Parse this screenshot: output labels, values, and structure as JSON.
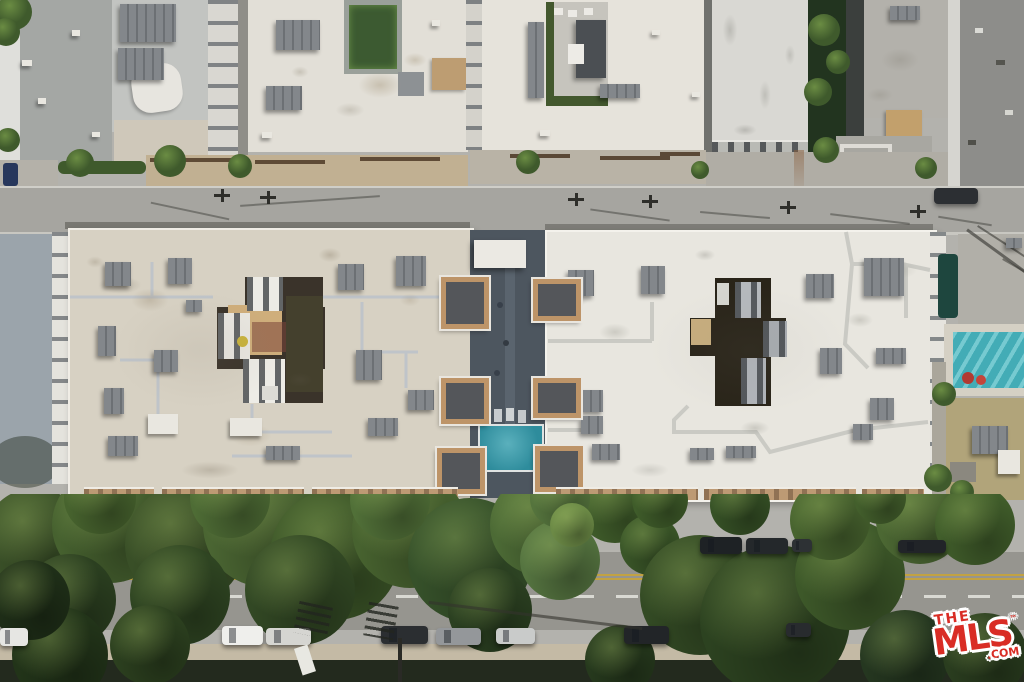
{
  "watermark": {
    "the": "THE",
    "mls": "MLS",
    "tm": "™",
    "com": ".COM"
  },
  "palette": {
    "background": "#b3b2ad",
    "roof_left_building": "#d7d1c3",
    "roof_right_building": "#e8e6df",
    "roof_top_white": "#e2dfd7",
    "road": "#a6a5a0",
    "road_lower": "#96958f",
    "sidewalk": "#c4baa5",
    "courtyard_deck": "#4d565f",
    "pool_center": "#2e8c9c",
    "pool_right": "#43acb6",
    "tan_trim": "#bd9a74",
    "tree_dark": "#2c4220",
    "tree_mid": "#3f5a2c",
    "shadow_strip": "#232a1e",
    "mls_red": "#d92d25"
  },
  "scene": {
    "units": [
      [
        120,
        4,
        56,
        38,
        "d"
      ],
      [
        118,
        48,
        46,
        32,
        "d"
      ],
      [
        276,
        20,
        44,
        30,
        "d"
      ],
      [
        266,
        86,
        36,
        24,
        "d"
      ],
      [
        600,
        84,
        40,
        14,
        "d"
      ],
      [
        890,
        6,
        30,
        14,
        "d"
      ],
      [
        528,
        22,
        16,
        76,
        "d"
      ],
      [
        22,
        60,
        10,
        6,
        "l"
      ],
      [
        38,
        98,
        8,
        6,
        "l"
      ],
      [
        72,
        30,
        8,
        6,
        "l"
      ],
      [
        92,
        132,
        8,
        5,
        "l"
      ],
      [
        262,
        132,
        10,
        6,
        "l"
      ],
      [
        432,
        20,
        8,
        6,
        "l"
      ],
      [
        652,
        30,
        8,
        5,
        "l"
      ],
      [
        692,
        92,
        8,
        5,
        "l"
      ],
      [
        540,
        130,
        10,
        6,
        "l"
      ],
      [
        105,
        262,
        26,
        24,
        "d"
      ],
      [
        168,
        258,
        24,
        26,
        "d"
      ],
      [
        338,
        264,
        26,
        26,
        "d"
      ],
      [
        396,
        256,
        30,
        30,
        "d"
      ],
      [
        98,
        326,
        18,
        30,
        "d"
      ],
      [
        154,
        350,
        24,
        22,
        "d"
      ],
      [
        104,
        388,
        20,
        26,
        "d"
      ],
      [
        108,
        436,
        30,
        20,
        "d"
      ],
      [
        356,
        350,
        26,
        30,
        "d"
      ],
      [
        408,
        390,
        26,
        20,
        "d"
      ],
      [
        368,
        418,
        30,
        18,
        "d"
      ],
      [
        266,
        446,
        34,
        14,
        "d"
      ],
      [
        186,
        300,
        16,
        12,
        "d"
      ],
      [
        148,
        414,
        30,
        20,
        "l"
      ],
      [
        230,
        418,
        32,
        18,
        "l"
      ],
      [
        568,
        270,
        26,
        26,
        "d"
      ],
      [
        641,
        266,
        24,
        28,
        "d"
      ],
      [
        806,
        274,
        28,
        24,
        "d"
      ],
      [
        864,
        258,
        40,
        38,
        "d"
      ],
      [
        820,
        348,
        22,
        26,
        "d"
      ],
      [
        876,
        348,
        30,
        16,
        "d"
      ],
      [
        870,
        398,
        24,
        22,
        "d"
      ],
      [
        853,
        424,
        20,
        16,
        "d"
      ],
      [
        726,
        446,
        30,
        12,
        "d"
      ],
      [
        583,
        390,
        20,
        22,
        "d"
      ],
      [
        581,
        416,
        22,
        18,
        "d"
      ],
      [
        592,
        444,
        28,
        16,
        "d"
      ],
      [
        690,
        448,
        24,
        12,
        "d"
      ],
      [
        972,
        426,
        36,
        28,
        "d"
      ],
      [
        1006,
        238,
        16,
        10,
        "d"
      ],
      [
        998,
        450,
        22,
        24,
        "l"
      ]
    ],
    "stains": [
      [
        150,
        300,
        26,
        16,
        "#8f7f66",
        0.3
      ],
      [
        250,
        435,
        30,
        16,
        "#8f8066",
        0.28
      ],
      [
        330,
        255,
        16,
        10,
        "#7c6f58",
        0.3
      ],
      [
        95,
        262,
        12,
        8,
        "#7c6f58",
        0.25
      ],
      [
        210,
        470,
        40,
        12,
        "#6e6352",
        0.25
      ],
      [
        410,
        300,
        14,
        9,
        "#8f7f66",
        0.22
      ],
      [
        300,
        380,
        18,
        10,
        "#5f584a",
        0.2
      ],
      [
        120,
        285,
        30,
        12,
        "#6b6253",
        0.3
      ],
      [
        200,
        350,
        120,
        80,
        "#8a8070",
        0.12
      ],
      [
        750,
        350,
        140,
        90,
        "#8e8a80",
        0.08
      ],
      [
        615,
        332,
        22,
        12,
        "#8a8a80",
        0.3
      ],
      [
        705,
        255,
        14,
        8,
        "#77776e",
        0.28
      ],
      [
        860,
        320,
        18,
        10,
        "#8a8a80",
        0.3
      ],
      [
        755,
        428,
        20,
        10,
        "#6f6f66",
        0.25
      ],
      [
        900,
        270,
        24,
        12,
        "#96968c",
        0.22
      ],
      [
        650,
        470,
        26,
        10,
        "#72726a",
        0.2
      ],
      [
        580,
        300,
        12,
        8,
        "#80807a",
        0.2
      ],
      [
        380,
        85,
        30,
        18,
        "#a89a80",
        0.45
      ],
      [
        415,
        60,
        16,
        10,
        "#a89a80",
        0.4
      ],
      [
        300,
        72,
        12,
        8,
        "#97907e",
        0.35
      ],
      [
        350,
        110,
        20,
        10,
        "#8f8878",
        0.3
      ],
      [
        730,
        30,
        10,
        22,
        "#8f8f88",
        0.4
      ],
      [
        765,
        95,
        8,
        20,
        "#8f8f88",
        0.35
      ],
      [
        790,
        55,
        7,
        14,
        "#85857e",
        0.3
      ],
      [
        745,
        130,
        16,
        8,
        "#6d6d66",
        0.3
      ],
      [
        900,
        60,
        26,
        16,
        "#8c887e",
        0.35
      ],
      [
        880,
        95,
        18,
        10,
        "#8c887e",
        0.3
      ]
    ],
    "shrubs": [
      [
        80,
        163,
        14
      ],
      [
        170,
        161,
        16
      ],
      [
        240,
        166,
        12
      ],
      [
        528,
        162,
        12
      ],
      [
        700,
        170,
        9
      ],
      [
        926,
        168,
        11
      ],
      [
        14,
        12,
        18
      ],
      [
        6,
        32,
        14
      ],
      [
        8,
        140,
        12
      ],
      [
        824,
        30,
        16
      ],
      [
        818,
        92,
        14
      ],
      [
        826,
        150,
        13
      ],
      [
        838,
        62,
        12
      ],
      [
        938,
        478,
        14
      ],
      [
        962,
        492,
        12
      ],
      [
        944,
        394,
        12
      ]
    ],
    "towers": [
      [
        441,
        277,
        38,
        42
      ],
      [
        441,
        378,
        38,
        36
      ],
      [
        437,
        448,
        38,
        36
      ],
      [
        533,
        279,
        38,
        32
      ],
      [
        533,
        378,
        38,
        30
      ],
      [
        535,
        446,
        38,
        36
      ]
    ],
    "balconies": [
      [
        84,
        70
      ],
      [
        162,
        142
      ],
      [
        312,
        146
      ],
      [
        556,
        142
      ],
      [
        704,
        152
      ],
      [
        862,
        62
      ]
    ],
    "trees": [
      [
        35,
        540,
        52,
        "#3c5329"
      ],
      [
        110,
        525,
        58,
        "#46612f"
      ],
      [
        185,
        545,
        60,
        "#394f27"
      ],
      [
        265,
        525,
        62,
        "#4a6532"
      ],
      [
        335,
        555,
        65,
        "#3c5628"
      ],
      [
        410,
        530,
        58,
        "#47622f"
      ],
      [
        300,
        590,
        55,
        "#324824"
      ],
      [
        180,
        595,
        50,
        "#2f4522"
      ],
      [
        70,
        600,
        46,
        "#2b3f20"
      ],
      [
        470,
        560,
        62,
        "#36512a"
      ],
      [
        540,
        525,
        50,
        "#4c6a35"
      ],
      [
        560,
        560,
        40,
        "#557440"
      ],
      [
        615,
        505,
        38,
        "#42602c"
      ],
      [
        490,
        610,
        42,
        "#2b4021"
      ],
      [
        650,
        545,
        30,
        "#3a5628"
      ],
      [
        700,
        595,
        60,
        "#334a24"
      ],
      [
        775,
        620,
        75,
        "#2c4220"
      ],
      [
        850,
        575,
        55,
        "#3d5829"
      ],
      [
        830,
        520,
        40,
        "#48642f"
      ],
      [
        920,
        520,
        44,
        "#4c6833"
      ],
      [
        975,
        525,
        40,
        "#415e2b"
      ],
      [
        905,
        655,
        45,
        "#253720"
      ],
      [
        985,
        655,
        42,
        "#2a3d1f"
      ],
      [
        620,
        660,
        35,
        "#26391d"
      ],
      [
        60,
        655,
        48,
        "#223419"
      ],
      [
        150,
        645,
        40,
        "#2c401f"
      ],
      [
        390,
        500,
        40,
        "#517038"
      ],
      [
        230,
        498,
        40,
        "#4e6c35"
      ],
      [
        100,
        498,
        36,
        "#47632e"
      ],
      [
        560,
        498,
        30,
        "#55743d"
      ],
      [
        660,
        500,
        28,
        "#3f5c2a"
      ],
      [
        740,
        505,
        30,
        "#365126"
      ],
      [
        880,
        498,
        26,
        "#435f2c"
      ],
      [
        30,
        600,
        40,
        "#1f2f18"
      ],
      [
        572,
        525,
        22,
        "#6c8a46"
      ]
    ],
    "cars_upper": [
      [
        700,
        537,
        42,
        17,
        "#1e2225"
      ],
      [
        746,
        538,
        42,
        16,
        "#24282b"
      ],
      [
        792,
        539,
        20,
        13,
        "#2d3134"
      ],
      [
        898,
        540,
        48,
        13,
        "#212428"
      ]
    ],
    "cars_lower": [
      [
        0,
        628,
        28,
        18,
        "#e6e6e3"
      ],
      [
        222,
        626,
        41,
        19,
        "#efefec"
      ],
      [
        266,
        628,
        45,
        17,
        "#d5d5d1"
      ],
      [
        381,
        626,
        47,
        18,
        "#2b2e31"
      ],
      [
        436,
        628,
        45,
        17,
        "#94979a"
      ],
      [
        496,
        628,
        39,
        16,
        "#c9cbca"
      ],
      [
        624,
        626,
        45,
        18,
        "#222528"
      ],
      [
        786,
        623,
        25,
        14,
        "#282b2e"
      ]
    ],
    "poles": [
      [
        222,
        194
      ],
      [
        268,
        196
      ],
      [
        576,
        198
      ],
      [
        650,
        200
      ],
      [
        788,
        206
      ],
      [
        918,
        210
      ]
    ],
    "wire_shadows": [
      [
        150,
        210,
        80,
        12
      ],
      [
        240,
        200,
        140,
        -4
      ],
      [
        590,
        214,
        80,
        8
      ],
      [
        700,
        214,
        70,
        5
      ],
      [
        830,
        218,
        80,
        7
      ],
      [
        938,
        220,
        54,
        9
      ]
    ],
    "ladder_shadows": [
      [
        296,
        604,
        34,
        32,
        12
      ],
      [
        366,
        604,
        30,
        34,
        10
      ]
    ],
    "long_shadows": [
      [
        428,
        614,
        215,
        7
      ]
    ],
    "pipes_left": "M70 297 H213 M323 297 H466 M152 262 V296 M252 404 V432 H332 M120 360 H158 V416 M362 302 V352 H418 M232 456 H352 M406 352 V388",
    "pipes_right": "M548 341 H652 M652 341 V302 M846 232 L852 264 L902 264 L930 270 M852 264 L845 344 L868 368 M906 264 V318 M688 406 L674 420 L674 432 H756 L770 452 L856 430 L928 422 M548 430 H598"
  }
}
